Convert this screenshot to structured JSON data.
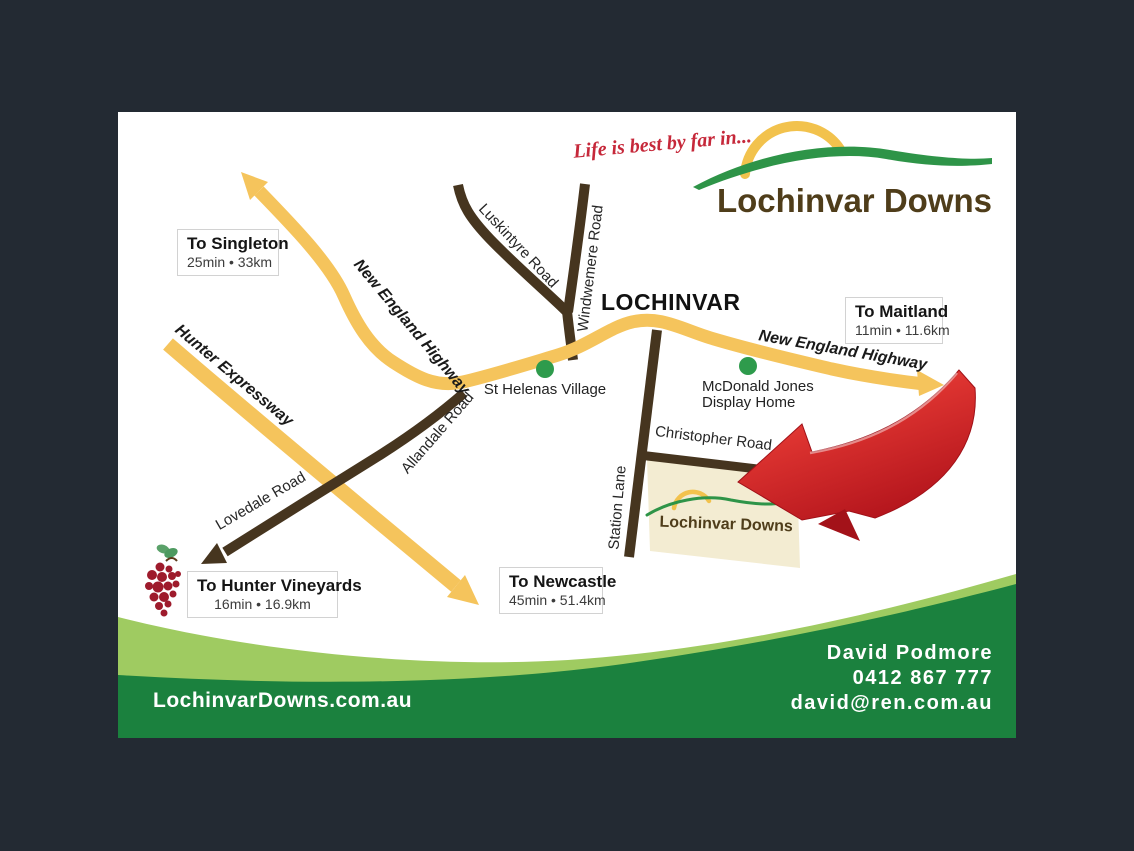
{
  "page": {
    "background": "#232a33",
    "card_background": "#ffffff"
  },
  "branding": {
    "tagline": "Life is best by far in...",
    "logo_text": "Lochinvar Downs",
    "colors": {
      "tagline_red": "#c6283a",
      "logo_brown": "#4f3d1a",
      "sun_yellow": "#f2c24d",
      "hill_green": "#2e9448"
    }
  },
  "map": {
    "town": "LOCHINVAR",
    "roads": {
      "new_england_left": "New England Highway",
      "new_england_right": "New England Highway",
      "hunter_expressway": "Hunter Expressway",
      "luskintyre": "Luskintyre Road",
      "windwemere": "Windwemere Road",
      "allandale": "Allandale Road",
      "lovedale": "Lovedale Road",
      "christopher": "Christopher Road",
      "station_lane": "Station Lane"
    },
    "pois": {
      "st_helenas": "St Helenas Village",
      "mcdonald_line1": "McDonald Jones",
      "mcdonald_line2": "Display Home"
    },
    "destinations": {
      "singleton": {
        "title": "To Singleton",
        "detail": "25min • 33km"
      },
      "maitland": {
        "title": "To Maitland",
        "detail": "11min • 11.6km"
      },
      "hunter_vineyards": {
        "title": "To Hunter Vineyards",
        "detail": "16min • 16.9km"
      },
      "newcastle": {
        "title": "To Newcastle",
        "detail": "45min • 51.4km"
      }
    },
    "parcel_label": "Lochinvar Downs",
    "colors": {
      "highway_yellow": "#f5c45c",
      "road_brown": "#46351f",
      "poi_green": "#2e9b4c",
      "parcel_beige": "#f3ecd2",
      "arrow_red": "#d2232a",
      "grape_red": "#9e1b2c"
    }
  },
  "footer": {
    "website": "LochinvarDowns.com.au",
    "agent_name": "David Podmore",
    "agent_phone": "0412 867 777",
    "agent_email": "david@ren.com.au",
    "colors": {
      "band_dark_green": "#1b813e",
      "band_light_green": "#9fcb61"
    }
  }
}
